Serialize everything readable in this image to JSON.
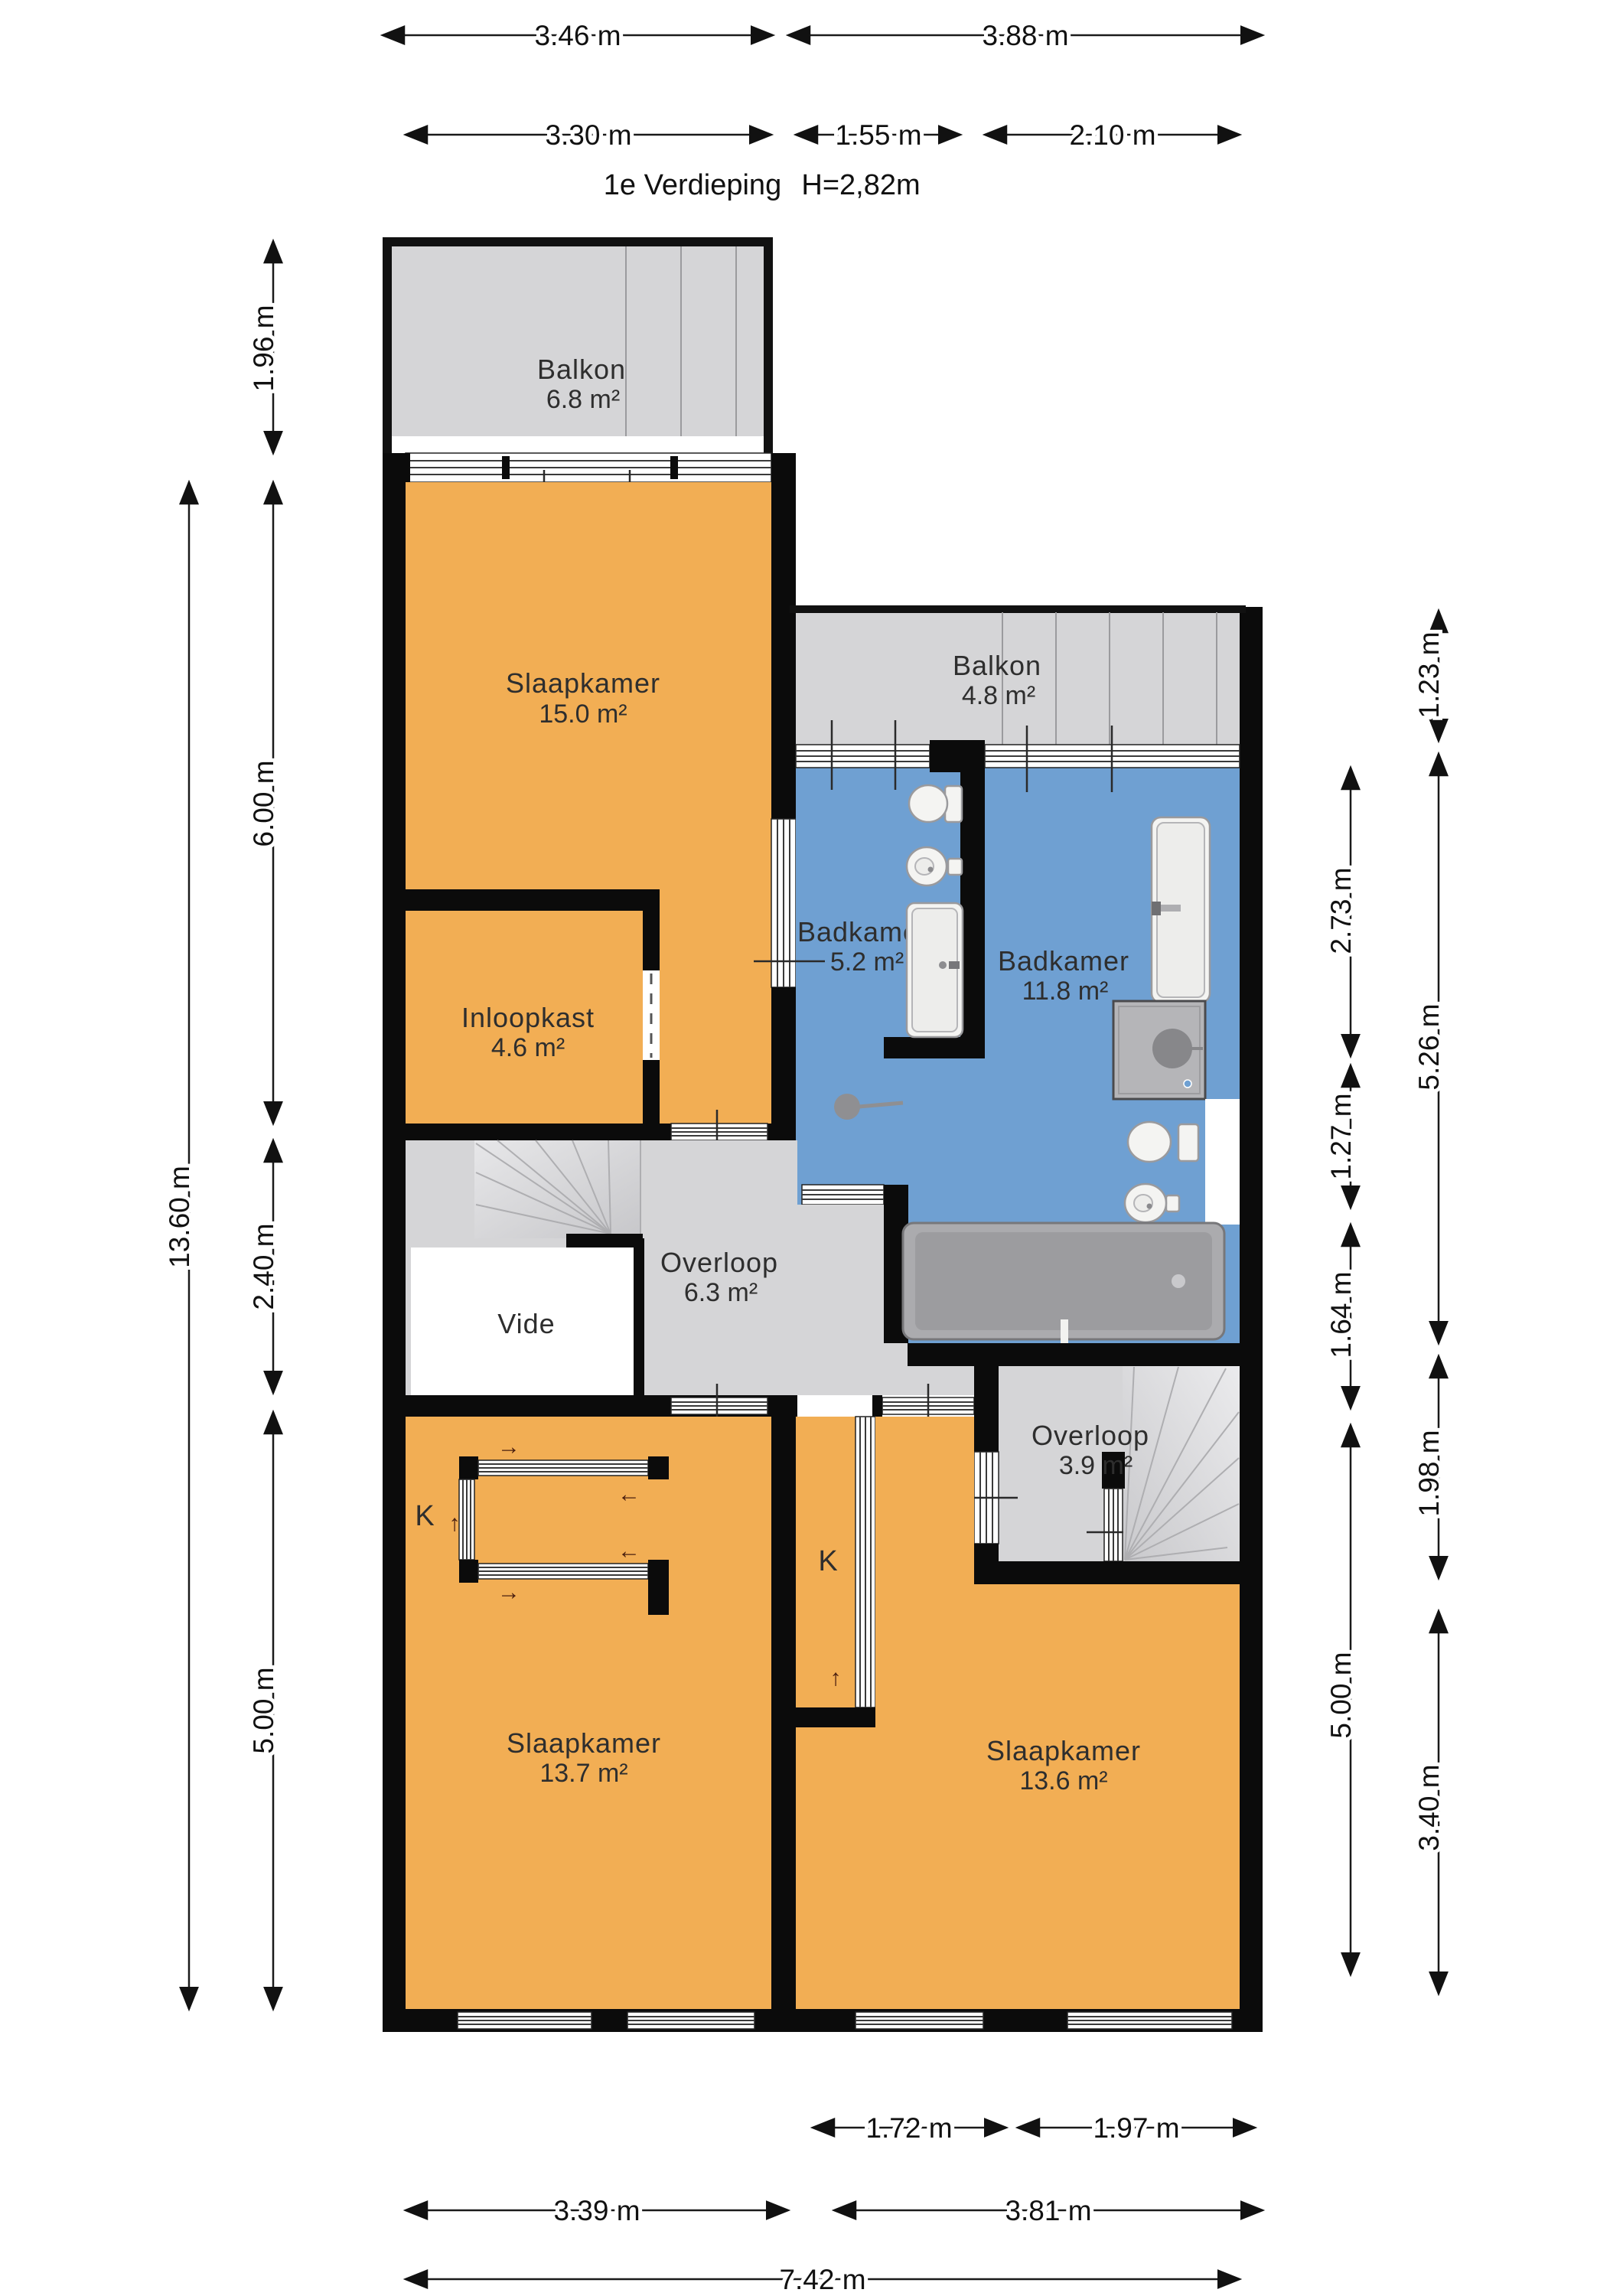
{
  "title": {
    "floor_label": "1e Verdieping",
    "ceiling_height": "H=2,82m"
  },
  "rooms": {
    "balkon_top": {
      "name": "Balkon",
      "area": "6.8 m²"
    },
    "slaapkamer_top": {
      "name": "Slaapkamer",
      "area": "15.0 m²"
    },
    "balkon_right": {
      "name": "Balkon",
      "area": "4.8 m²"
    },
    "badkamer_small": {
      "name": "Badkamer",
      "area": "5.2 m²"
    },
    "badkamer_large": {
      "name": "Badkamer",
      "area": "11.8 m²"
    },
    "inloopkast": {
      "name": "Inloopkast",
      "area": "4.6 m²"
    },
    "vide": {
      "name": "Vide"
    },
    "overloop_mid": {
      "name": "Overloop",
      "area": "6.3 m²"
    },
    "overloop_right": {
      "name": "Overloop",
      "area": "3.9 m²"
    },
    "slaapkamer_left": {
      "name": "Slaapkamer",
      "area": "13.7 m²"
    },
    "slaapkamer_right": {
      "name": "Slaapkamer",
      "area": "13.6 m²"
    },
    "closet_left": {
      "name": "K"
    },
    "closet_mid": {
      "name": "K"
    }
  },
  "dimensions": {
    "top_row1": [
      {
        "label": "3.46 m"
      },
      {
        "label": "3.88 m"
      }
    ],
    "top_row2": [
      {
        "label": "3.30 m"
      },
      {
        "label": "1.55 m"
      },
      {
        "label": "2.10 m"
      }
    ],
    "left_outer": [
      {
        "label": "13.60 m"
      }
    ],
    "left_inner": [
      {
        "label": "1.96 m"
      },
      {
        "label": "6.00 m"
      },
      {
        "label": "2.40 m"
      },
      {
        "label": "5.00 m"
      }
    ],
    "right_inner": [
      {
        "label": "2.73 m"
      },
      {
        "label": "1.27 m"
      },
      {
        "label": "1.64 m"
      },
      {
        "label": "5.00 m"
      }
    ],
    "right_outer": [
      {
        "label": "1.23 m"
      },
      {
        "label": "5.26 m"
      },
      {
        "label": "1.98 m"
      },
      {
        "label": "3.40 m"
      }
    ],
    "bottom_row1": [
      {
        "label": "1.72 m"
      },
      {
        "label": "1.97 m"
      }
    ],
    "bottom_row2": [
      {
        "label": "3.39 m"
      },
      {
        "label": "3.81 m"
      }
    ],
    "bottom_row3": [
      {
        "label": "7.42 m"
      }
    ]
  },
  "symbols": {
    "up": "↑",
    "down": "↓",
    "left": "←",
    "right": "→"
  },
  "colors": {
    "room_orange": "#F2AE54",
    "room_blue": "#6FA0D2",
    "floor_gray": "#D5D5D7",
    "wall_black": "#0B0B0B",
    "background": "#FFFFFF"
  }
}
